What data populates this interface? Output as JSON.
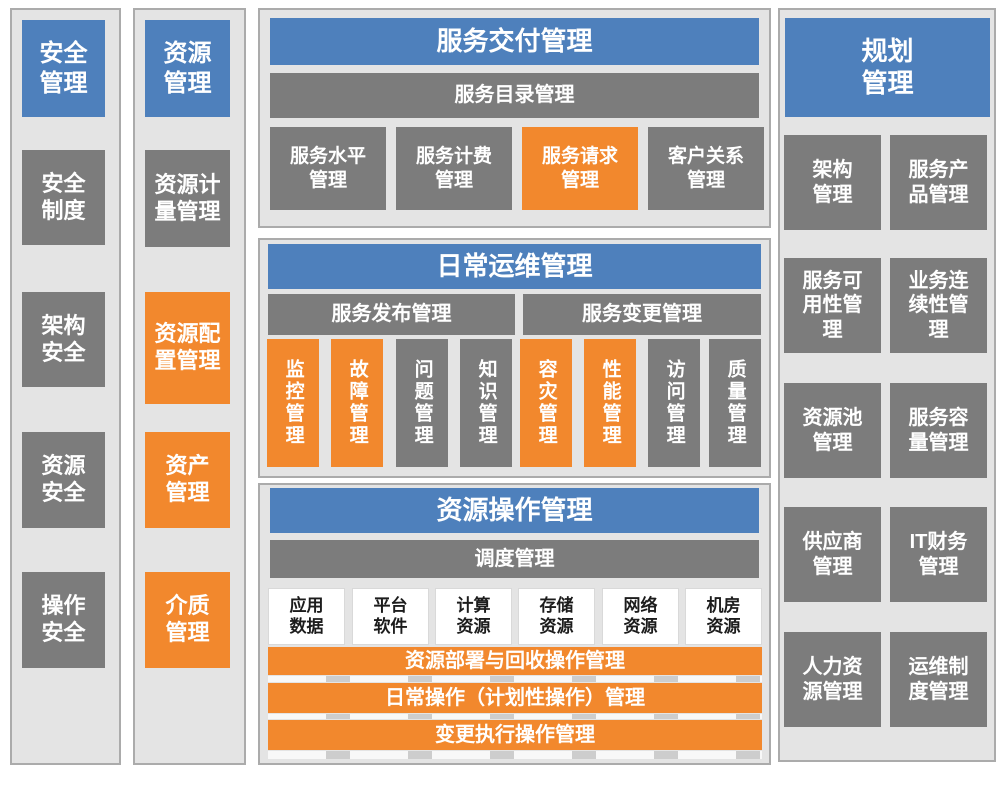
{
  "colors": {
    "blue": "#4E80BC",
    "orange": "#F2882D",
    "gray": "#7C7C7C",
    "panel_bg": "#E4E4E4",
    "panel_border": "#ABABAB"
  },
  "security": {
    "title": "安全\n管理",
    "items": [
      {
        "label": "安全\n制度",
        "color": "gray"
      },
      {
        "label": "架构\n安全",
        "color": "gray"
      },
      {
        "label": "资源\n安全",
        "color": "gray"
      },
      {
        "label": "操作\n安全",
        "color": "gray"
      }
    ]
  },
  "resource": {
    "title": "资源\n管理",
    "items": [
      {
        "label": "资源计\n量管理",
        "color": "gray"
      },
      {
        "label": "资源配\n置管理",
        "color": "orange"
      },
      {
        "label": "资产\n管理",
        "color": "orange"
      },
      {
        "label": "介质\n管理",
        "color": "orange"
      }
    ]
  },
  "service_delivery": {
    "title": "服务交付管理",
    "catalog_bar": "服务目录管理",
    "items": [
      {
        "label": "服务水平\n管理",
        "color": "gray"
      },
      {
        "label": "服务计费\n管理",
        "color": "gray"
      },
      {
        "label": "服务请求\n管理",
        "color": "orange"
      },
      {
        "label": "客户关系\n管理",
        "color": "gray"
      }
    ]
  },
  "daily_ops": {
    "title": "日常运维管理",
    "release_bar": "服务发布管理",
    "change_bar": "服务变更管理",
    "items": [
      {
        "label": "监控管理",
        "color": "orange"
      },
      {
        "label": "故障管理",
        "color": "orange"
      },
      {
        "label": "问题管理",
        "color": "gray"
      },
      {
        "label": "知识管理",
        "color": "gray"
      },
      {
        "label": "容灾管理",
        "color": "orange"
      },
      {
        "label": "性能管理",
        "color": "orange"
      },
      {
        "label": "访问管理",
        "color": "gray"
      },
      {
        "label": "质量管理",
        "color": "gray"
      }
    ]
  },
  "resource_ops": {
    "title": "资源操作管理",
    "scheduling_bar": "调度管理",
    "resources": [
      {
        "label": "应用\n数据"
      },
      {
        "label": "平台\n软件"
      },
      {
        "label": "计算\n资源"
      },
      {
        "label": "存储\n资源"
      },
      {
        "label": "网络\n资源"
      },
      {
        "label": "机房\n资源"
      }
    ],
    "bars": [
      {
        "label": "资源部署与回收操作管理"
      },
      {
        "label": "日常操作（计划性操作）管理"
      },
      {
        "label": "变更执行操作管理"
      }
    ]
  },
  "planning": {
    "title": "规划\n管理",
    "items": [
      {
        "label": "架构\n管理",
        "color": "gray"
      },
      {
        "label": "服务产\n品管理",
        "color": "gray"
      },
      {
        "label": "服务可\n用性管\n理",
        "color": "gray"
      },
      {
        "label": "业务连\n续性管\n理",
        "color": "gray"
      },
      {
        "label": "资源池\n管理",
        "color": "gray"
      },
      {
        "label": "服务容\n量管理",
        "color": "gray"
      },
      {
        "label": "供应商\n管理",
        "color": "gray"
      },
      {
        "label": "IT财务\n管理",
        "color": "gray"
      },
      {
        "label": "人力资\n源管理",
        "color": "gray"
      },
      {
        "label": "运维制\n度管理",
        "color": "gray"
      }
    ]
  }
}
